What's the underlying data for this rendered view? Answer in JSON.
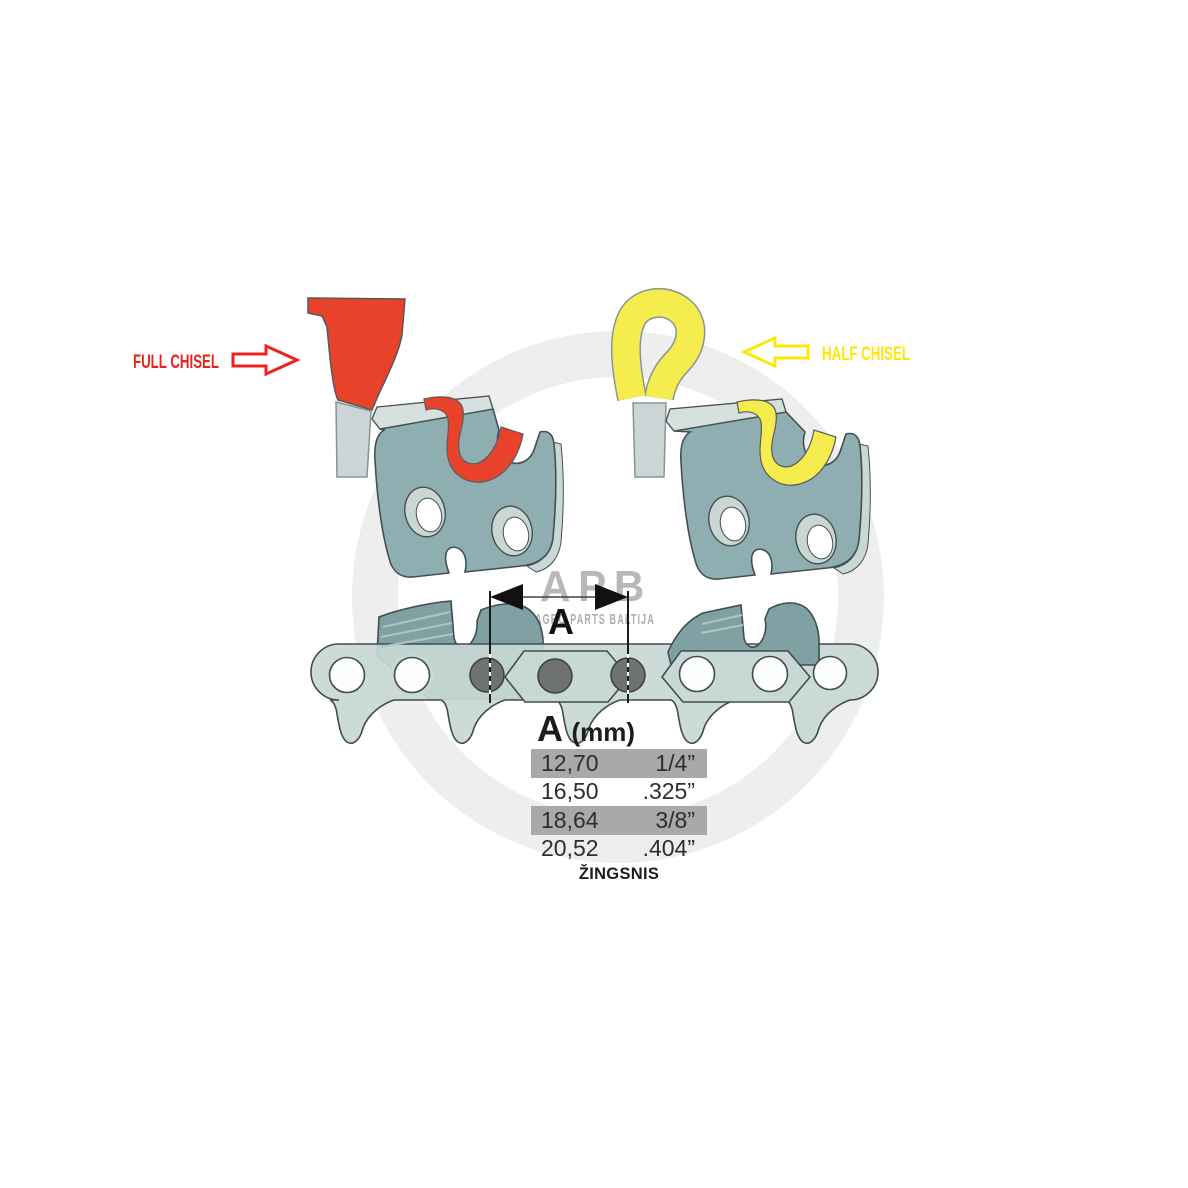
{
  "labels": {
    "full_chisel": "FULL CHISEL",
    "half_chisel": "HALF CHISEL"
  },
  "watermark": {
    "logo": "APB",
    "subtitle": "AGRO PARTS BALTIJA"
  },
  "dimension": {
    "letter": "A"
  },
  "pitch_table": {
    "header": {
      "letter": "A",
      "unit": "(mm)"
    },
    "rows": [
      {
        "mm": "12,70",
        "inch": "1/4”",
        "highlighted": true
      },
      {
        "mm": "16,50",
        "inch": ".325”",
        "highlighted": false
      },
      {
        "mm": "18,64",
        "inch": "3/8”",
        "highlighted": true
      },
      {
        "mm": "20,52",
        "inch": ".404”",
        "highlighted": false
      }
    ],
    "caption": "ŽINGSNIS"
  },
  "colors": {
    "full_chisel_red": "#e8432a",
    "half_chisel_yellow": "#f5ec4d",
    "label_red": "#e8241e",
    "label_yellow": "#ffe607",
    "steel_teal": "#8faeb1",
    "steel_dark": "#7fa1a4",
    "chain_light": "#c8d8d4",
    "rivet_gray": "#6f7272",
    "table_row_gray": "#a9a9a9",
    "watermark_gray": "#b8b8b8"
  }
}
